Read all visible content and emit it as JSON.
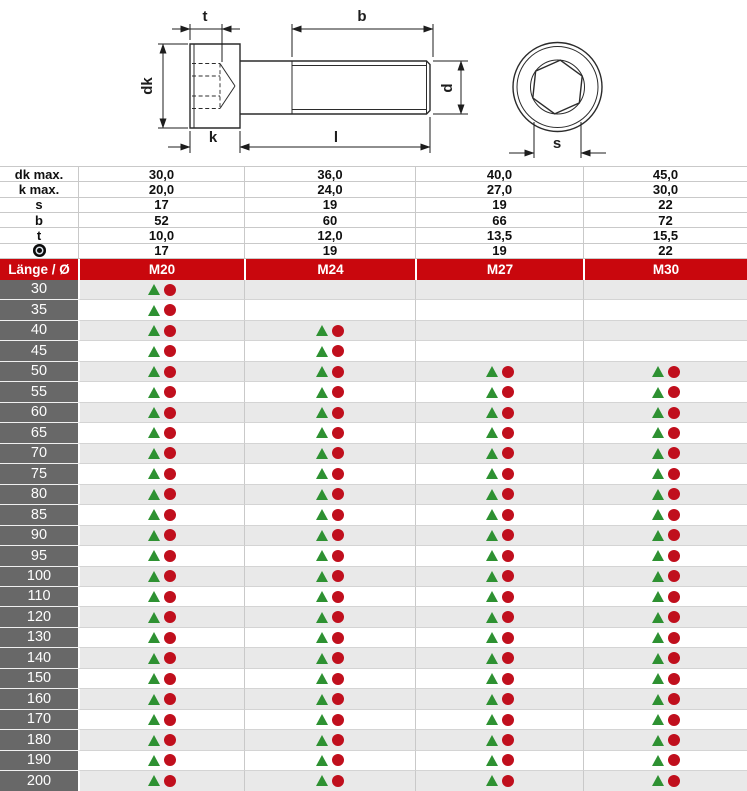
{
  "diagram": {
    "dim_labels": {
      "t": "t",
      "b": "b",
      "dk": "dk",
      "k": "k",
      "l": "l",
      "d": "d",
      "s": "s"
    }
  },
  "spec": {
    "rows": [
      {
        "label": "dk max.",
        "symbol": false,
        "values": [
          "30,0",
          "36,0",
          "40,0",
          "45,0"
        ]
      },
      {
        "label": "k max.",
        "symbol": false,
        "values": [
          "20,0",
          "24,0",
          "27,0",
          "30,0"
        ]
      },
      {
        "label": "s",
        "symbol": false,
        "values": [
          "17",
          "19",
          "19",
          "22"
        ]
      },
      {
        "label": "b",
        "symbol": false,
        "values": [
          "52",
          "60",
          "66",
          "72"
        ]
      },
      {
        "label": "t",
        "symbol": false,
        "values": [
          "10,0",
          "12,0",
          "13,5",
          "15,5"
        ]
      },
      {
        "label": "",
        "symbol": true,
        "values": [
          "17",
          "19",
          "19",
          "22"
        ]
      }
    ]
  },
  "table": {
    "corner_label": "Länge / Ø",
    "columns": [
      "M20",
      "M24",
      "M27",
      "M30"
    ],
    "rows": [
      {
        "length": "30",
        "available": [
          true,
          false,
          false,
          false
        ]
      },
      {
        "length": "35",
        "available": [
          true,
          false,
          false,
          false
        ]
      },
      {
        "length": "40",
        "available": [
          true,
          true,
          false,
          false
        ]
      },
      {
        "length": "45",
        "available": [
          true,
          true,
          false,
          false
        ]
      },
      {
        "length": "50",
        "available": [
          true,
          true,
          true,
          true
        ]
      },
      {
        "length": "55",
        "available": [
          true,
          true,
          true,
          true
        ]
      },
      {
        "length": "60",
        "available": [
          true,
          true,
          true,
          true
        ]
      },
      {
        "length": "65",
        "available": [
          true,
          true,
          true,
          true
        ]
      },
      {
        "length": "70",
        "available": [
          true,
          true,
          true,
          true
        ]
      },
      {
        "length": "75",
        "available": [
          true,
          true,
          true,
          true
        ]
      },
      {
        "length": "80",
        "available": [
          true,
          true,
          true,
          true
        ]
      },
      {
        "length": "85",
        "available": [
          true,
          true,
          true,
          true
        ]
      },
      {
        "length": "90",
        "available": [
          true,
          true,
          true,
          true
        ]
      },
      {
        "length": "95",
        "available": [
          true,
          true,
          true,
          true
        ]
      },
      {
        "length": "100",
        "available": [
          true,
          true,
          true,
          true
        ]
      },
      {
        "length": "110",
        "available": [
          true,
          true,
          true,
          true
        ]
      },
      {
        "length": "120",
        "available": [
          true,
          true,
          true,
          true
        ]
      },
      {
        "length": "130",
        "available": [
          true,
          true,
          true,
          true
        ]
      },
      {
        "length": "140",
        "available": [
          true,
          true,
          true,
          true
        ]
      },
      {
        "length": "150",
        "available": [
          true,
          true,
          true,
          true
        ]
      },
      {
        "length": "160",
        "available": [
          true,
          true,
          true,
          true
        ]
      },
      {
        "length": "170",
        "available": [
          true,
          true,
          true,
          true
        ]
      },
      {
        "length": "180",
        "available": [
          true,
          true,
          true,
          true
        ]
      },
      {
        "length": "190",
        "available": [
          true,
          true,
          true,
          true
        ]
      },
      {
        "length": "200",
        "available": [
          true,
          true,
          true,
          true
        ]
      }
    ]
  },
  "colors": {
    "header_red": "#c9070d",
    "row_dark": "#686868",
    "row_stripe": "#e9e9e9",
    "marker_green": "#2e9132",
    "marker_red": "#c00f1d"
  }
}
